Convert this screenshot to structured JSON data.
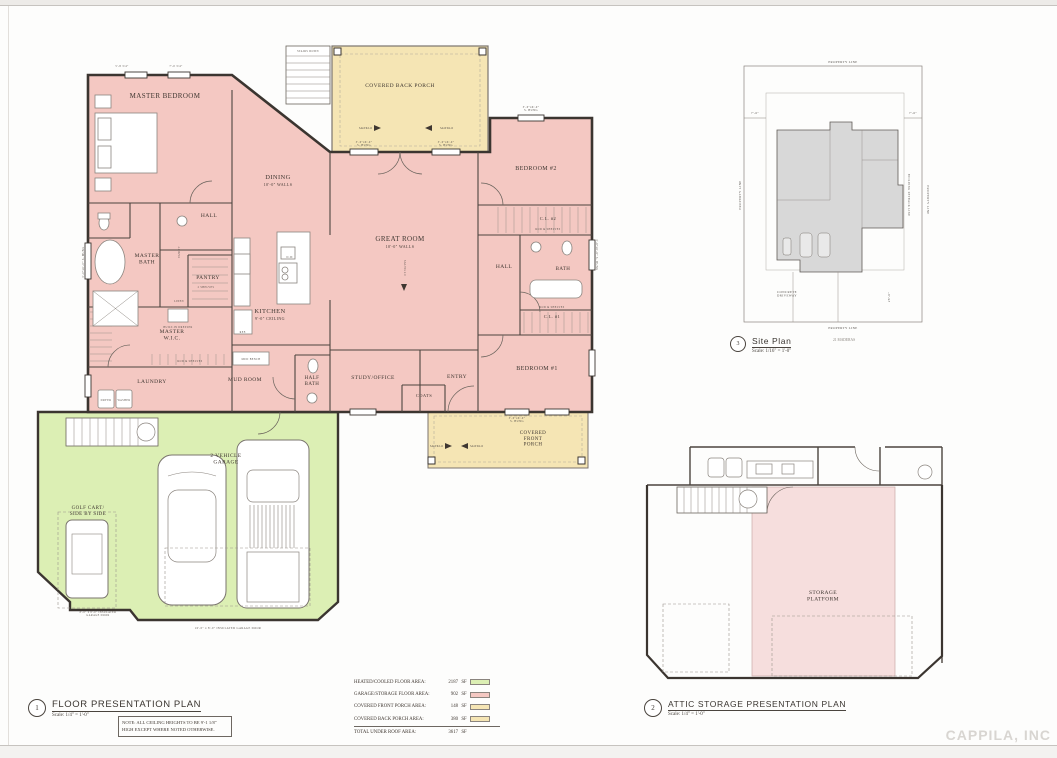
{
  "titles": {
    "floor": {
      "num": "1",
      "label": "FLOOR  PRESENTATION PLAN",
      "scale": "Scale: 1/4\" = 1'-0\""
    },
    "attic": {
      "num": "2",
      "label": "ATTIC STORAGE PRESENTATION PLAN",
      "scale": "Scale: 1/4\" = 1'-0\""
    },
    "site": {
      "num": "3",
      "label": "Site Plan",
      "scale": "Scale: 1/16\" = 1'-0\"",
      "address": "21 MADERAS"
    }
  },
  "note": "NOTE: ALL CEILING HEIGHTS TO BE 9'-1 1/8\" HIGH EXCEPT WHERE NOTED OTHERWISE.",
  "watermark": "CAPPILA, INC",
  "legend": {
    "rows": [
      {
        "label": "HEATED/COOLED FLOOR AREA:",
        "value": "2187",
        "unit": "SF",
        "swatch": "#dcefb4"
      },
      {
        "label": "GARAGE/STORAGE FLOOR AREA:",
        "value": "902",
        "unit": "SF",
        "swatch": "#f4c8c2"
      },
      {
        "label": "COVERED FRONT PORCH AREA:",
        "value": "148",
        "unit": "SF",
        "swatch": "#f5e5b4"
      },
      {
        "label": "COVERED BACK PORCH AREA:",
        "value": "380",
        "unit": "SF",
        "swatch": "#f5e5b4"
      },
      {
        "label": "TOTAL UNDER ROOF AREA:",
        "value": "3617",
        "unit": "SF",
        "swatch": null
      }
    ]
  },
  "colors": {
    "heated_fill": "#f4c8c2",
    "garage_fill": "#dcefb4",
    "porch_fill": "#f5e5b4",
    "attic_storage_fill": "#f6dedd",
    "site_building_fill": "#d8d8d8",
    "wall": "#3b3530"
  },
  "rooms": {
    "master_bedroom": "MASTER BEDROOM",
    "dining": "DINING",
    "dining_sub": "10'-0\" WALLS",
    "great_room": "GREAT ROOM",
    "great_room_sub": "10'-0\" WALLS",
    "kitchen": "KITCHEN",
    "kitchen_sub": "9'-0\" CEILING",
    "hall": "HALL",
    "master_bath": "MASTER\nBATH",
    "pantry": "PANTRY",
    "master_wic": "MASTER\nW.I.C.",
    "laundry": "LAUNDRY",
    "mud_room": "MUD ROOM",
    "half_bath": "HALF\nBATH",
    "study_office": "STUDY/OFFICE",
    "entry": "ENTRY",
    "coats": "COATS",
    "bedroom_2": "BEDROOM #2",
    "bedroom_1": "BEDROOM #1",
    "bath": "BATH",
    "cl2": "C.L. #2",
    "cl1": "C.L. #1",
    "covered_back_porch": "COVERED BACK PORCH",
    "covered_front_porch": "COVERED\nFRONT\nPORCH",
    "garage": "2 VEHICLE\nGARAGE",
    "golf_cart": "GOLF CART/\nSIDE BY SIDE",
    "storage_platform": "STORAGE\nPLATFORM"
  },
  "annotations": {
    "saltillo": "SALTILLO",
    "stairs_down": "STAIRS DOWN",
    "rod_shelves": "ROD & SHELVES",
    "built_in_dresser": "BUILT-IN DRESSER",
    "washer": "WASHER",
    "dryer": "DRYER",
    "linen": "LINEN",
    "vanity": "VANITY",
    "two_shelves": "2 SHELVES",
    "mud_bench": "MUD BENCH",
    "dw": "D.W.",
    "ref": "REF.",
    "dim_a": "5'-8 3/4\"",
    "dim_b": "7'-0 3/4\"",
    "window_small": "3'-0\"x6'-0\"\nS. HUNG",
    "window_small_one": "3'-0\"x6'-0\" S. HUNG",
    "garage_door_single": "8'-0\" x 8'-0\" INSULATED\nGARAGE DOOR",
    "garage_door_double": "16'-0\" x 8'-0\" INSULATED GARAGE DOOR"
  },
  "site": {
    "property_line": "PROPERTY LINE",
    "setback_line": "BUILDING SETBACK LINE",
    "driveway": "CONCRETE\nDRIVEWAY",
    "dim_left": "7'-6\"",
    "dim_right": "7'-6\"",
    "dim_bottom": "28'-0\""
  }
}
